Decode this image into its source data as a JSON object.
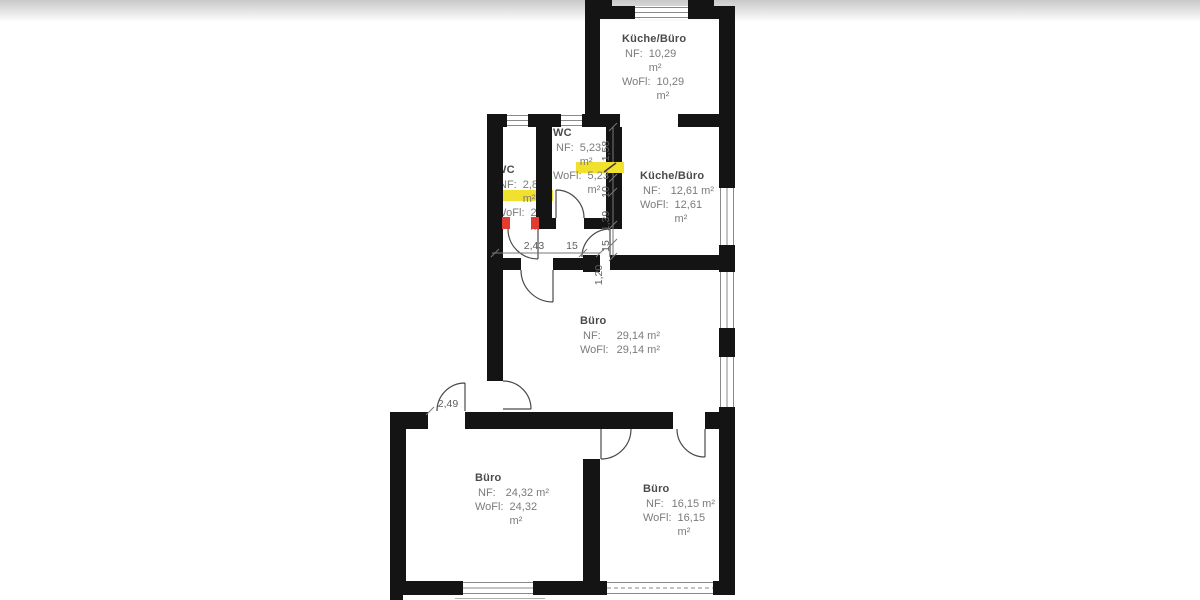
{
  "plan": {
    "labels": {
      "nf": "NF:",
      "wofl": "WoFl:"
    },
    "rooms": {
      "kueche_top": {
        "name": "Küche/Büro",
        "nf": "10,29 m²",
        "wofl": "10,29 m²"
      },
      "wc_left": {
        "name": "WC",
        "nf": "2,81 m²",
        "wofl": "2,81 m²"
      },
      "wc_right": {
        "name": "WC",
        "nf": "5,23 m²",
        "wofl": "5,23 m²"
      },
      "kueche_right": {
        "name": "Küche/Büro",
        "nf": "12,61 m²",
        "wofl": "12,61 m²"
      },
      "buero_main": {
        "name": "Büro",
        "nf": "29,14 m²",
        "wofl": "29,14 m²"
      },
      "buero_bottom_left": {
        "name": "Büro",
        "nf": "24,32 m²",
        "wofl": "24,32 m²"
      },
      "buero_bottom_right": {
        "name": "Büro",
        "nf": "16,15 m²",
        "wofl": "16,15 m²"
      }
    },
    "dimensions": {
      "corridor_length": "2,43",
      "wall_thickness": "15",
      "door_width_vertical": "1,20",
      "chain_top": "1,58",
      "chain_mid": "10",
      "chain_lower": "1,39",
      "chain_bottom": "15",
      "entry_door_width": "2,49"
    },
    "colors": {
      "wall": "#141414",
      "highlight_yellow": "#f2e02e",
      "mark_red": "#e23b30"
    }
  }
}
